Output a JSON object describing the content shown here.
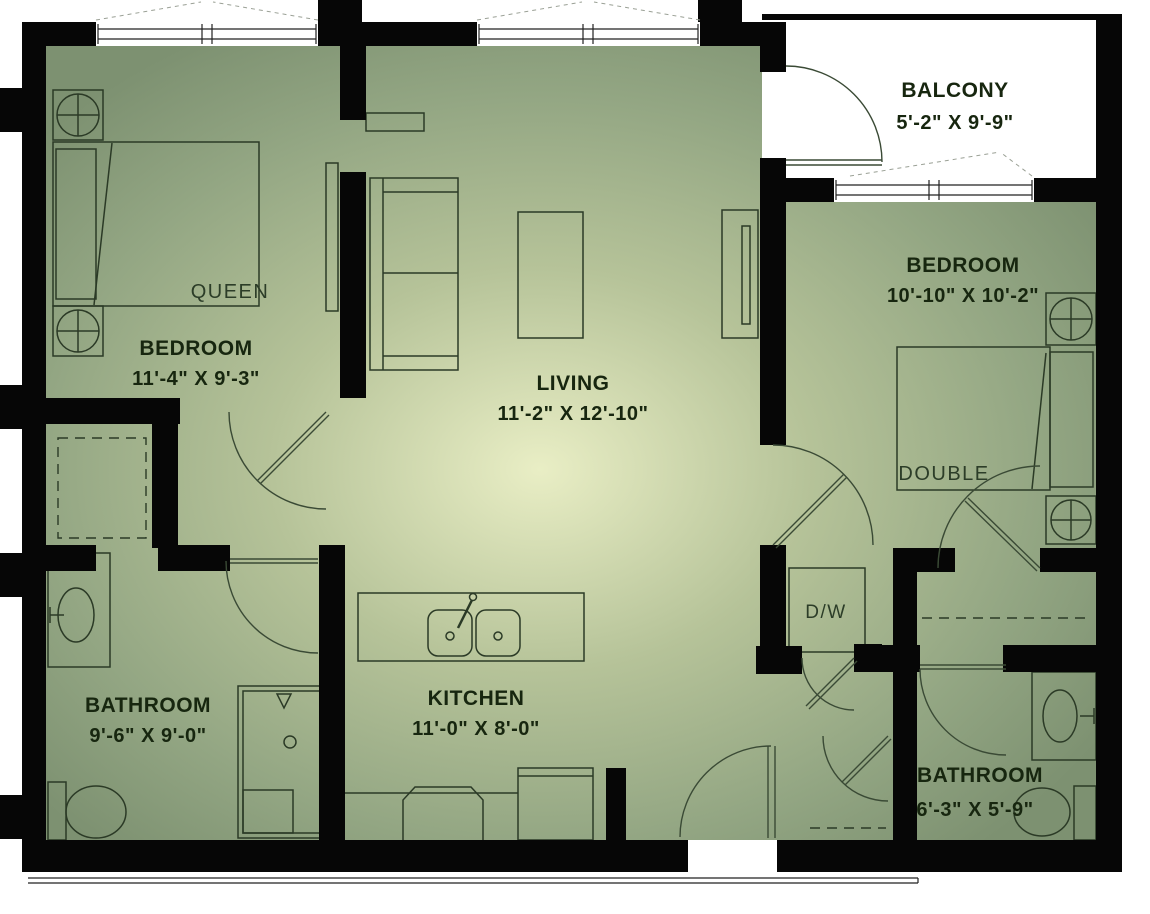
{
  "rooms": {
    "balcony": {
      "name": "BALCONY",
      "dims": "5'-2\" X 9'-9\""
    },
    "bedroom1": {
      "name": "BEDROOM",
      "dims": "11'-4\" X 9'-3\""
    },
    "living": {
      "name": "LIVING",
      "dims": "11'-2\" X 12'-10\""
    },
    "bedroom2": {
      "name": "BEDROOM",
      "dims": "10'-10\" X 10'-2\""
    },
    "bathroom1": {
      "name": "BATHROOM",
      "dims": "9'-6\" X 9'-0\""
    },
    "kitchen": {
      "name": "KITCHEN",
      "dims": "11'-0\" X 8'-0\""
    },
    "bathroom2": {
      "name": "BATHROOM",
      "dims": "6'-3\" X 5'-9\""
    }
  },
  "furniture_labels": {
    "queen_bed": "QUEEN",
    "double_bed": "DOUBLE",
    "dishwasher": "D/W"
  },
  "colors": {
    "wall": "#060606",
    "line": "#2b3a26",
    "floor_edge": "#7d9171",
    "floor_mid": "#b6c399",
    "floor_glow": "#e9eec5",
    "balcony_floor": "#ffffff",
    "label_text": "#17260f"
  }
}
